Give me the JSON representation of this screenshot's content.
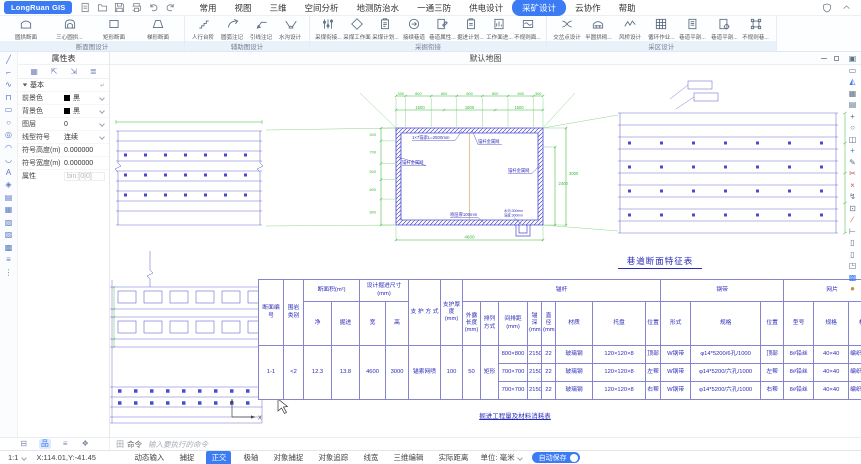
{
  "app": {
    "title": "LongRuan GIS"
  },
  "topbar": {
    "menu": [
      {
        "label": "常用"
      },
      {
        "label": "视图"
      },
      {
        "label": "三维"
      },
      {
        "label": "空间分析"
      },
      {
        "label": "地测防治水"
      },
      {
        "label": "一通三防"
      },
      {
        "label": "供电设计"
      },
      {
        "label": "采矿设计"
      },
      {
        "label": "云协作"
      },
      {
        "label": "帮助"
      }
    ]
  },
  "ribbon": {
    "groups": [
      {
        "label": "断面图设计",
        "items": [
          {
            "label": "圆拱断面",
            "icon": "#i-arch"
          },
          {
            "label": "三心圆拱...",
            "icon": "#i-arch3"
          },
          {
            "label": "矩形断面",
            "icon": "#i-rect"
          },
          {
            "label": "梯形断面",
            "icon": "#i-trap"
          }
        ]
      },
      {
        "label": "辅助图设计",
        "items": [
          {
            "label": "人行台阶",
            "icon": "#i-steps"
          },
          {
            "label": "圆弧注记",
            "icon": "#i-arc"
          },
          {
            "label": "引线注记",
            "icon": "#i-leader"
          },
          {
            "label": "水沟设计",
            "icon": "#i-ditch"
          }
        ]
      },
      {
        "label": "采掘衔接",
        "items": [
          {
            "label": "采煤衔接...",
            "icon": "#i-sliders"
          },
          {
            "label": "采煤工作面",
            "icon": "#i-diamond"
          },
          {
            "label": "采煤计划...",
            "icon": "#i-clip"
          },
          {
            "label": "接续巷道",
            "icon": "#i-link"
          },
          {
            "label": "巷道属性...",
            "icon": "#i-docpen"
          },
          {
            "label": "掘进计划...",
            "icon": "#i-clip2"
          },
          {
            "label": "工作面进...",
            "icon": "#i-docchart"
          },
          {
            "label": "不规则面...",
            "icon": "#i-wave"
          }
        ]
      },
      {
        "label": "采区设计",
        "items": [
          {
            "label": "交岔点设计",
            "icon": "#i-swap"
          },
          {
            "label": "半圆拱砌...",
            "icon": "#i-halfarch"
          },
          {
            "label": "风桥设计",
            "icon": "#i-zig"
          },
          {
            "label": "循环作业...",
            "icon": "#i-grid"
          },
          {
            "label": "巷道平剖...",
            "icon": "#i-docline"
          },
          {
            "label": "巷道平剖...",
            "icon": "#i-docgear"
          },
          {
            "label": "不规则巷...",
            "icon": "#i-corner"
          }
        ]
      }
    ]
  },
  "left_toolbar": {
    "tools": [
      {
        "name": "line",
        "glyph": "╱"
      },
      {
        "name": "polyline",
        "glyph": "⌐"
      },
      {
        "name": "spline",
        "glyph": "∿"
      },
      {
        "name": "multiline",
        "glyph": "⊓"
      },
      {
        "name": "rectangle",
        "glyph": "▭"
      },
      {
        "name": "circle",
        "glyph": "○"
      },
      {
        "name": "circle-center",
        "glyph": "◎"
      },
      {
        "name": "arc",
        "glyph": "◠"
      },
      {
        "name": "ellipse",
        "glyph": "◡"
      },
      {
        "name": "text",
        "glyph": "A"
      },
      {
        "name": "hatch",
        "glyph": "◈"
      },
      {
        "name": "image",
        "glyph": "▤"
      },
      {
        "name": "block",
        "glyph": "▦"
      },
      {
        "name": "xref",
        "glyph": "▧"
      },
      {
        "name": "region",
        "glyph": "▨"
      },
      {
        "name": "map",
        "glyph": "▩"
      },
      {
        "name": "align",
        "glyph": "≡"
      },
      {
        "name": "more",
        "glyph": "⋮"
      }
    ]
  },
  "right_toolbar": {
    "tools": [
      {
        "name": "copy",
        "glyph": "▣"
      },
      {
        "name": "delete",
        "glyph": "▭"
      },
      {
        "name": "mirror",
        "glyph": "◭"
      },
      {
        "name": "array",
        "glyph": "▦"
      },
      {
        "name": "print-area",
        "glyph": "▤"
      },
      {
        "name": "move",
        "glyph": "+"
      },
      {
        "name": "rotate",
        "glyph": "○"
      },
      {
        "name": "duplicate",
        "glyph": "◫"
      },
      {
        "name": "add",
        "glyph": "+"
      },
      {
        "name": "pencil",
        "glyph": "✎"
      },
      {
        "name": "cut",
        "glyph": "✂"
      },
      {
        "name": "break",
        "glyph": "×"
      },
      {
        "name": "stretch",
        "glyph": "↯"
      },
      {
        "name": "marquee",
        "glyph": "⊡"
      },
      {
        "name": "trim",
        "glyph": "∕"
      },
      {
        "name": "extend",
        "glyph": "⊢"
      },
      {
        "name": "clipboard",
        "glyph": "▯"
      },
      {
        "name": "clipboard-paste",
        "glyph": "▯"
      },
      {
        "name": "view-cube",
        "glyph": "◳"
      },
      {
        "name": "pattern",
        "glyph": "▩"
      },
      {
        "name": "sphere",
        "glyph": "●"
      }
    ]
  },
  "panel": {
    "title": "属性表",
    "tabs": [
      {
        "name": "properties",
        "glyph": "▦"
      },
      {
        "name": "select",
        "glyph": "⇱"
      },
      {
        "name": "pick",
        "glyph": "⇲"
      },
      {
        "name": "layers",
        "glyph": "≣"
      }
    ],
    "section": "基本",
    "rows": [
      {
        "label": "前景色",
        "value": "黑"
      },
      {
        "label": "背景色",
        "value": "黑"
      },
      {
        "label": "图层",
        "value": "0"
      },
      {
        "label": "线型符号",
        "value": "连续"
      },
      {
        "label": "符号高度(m)",
        "value": "0.000000"
      },
      {
        "label": "符号宽度(m)",
        "value": "0.000000"
      },
      {
        "label": "属性",
        "value": "bin:[0|0]"
      }
    ]
  },
  "bottom_tabs": {
    "tabs": [
      {
        "name": "list",
        "glyph": "⊟"
      },
      {
        "name": "structure",
        "glyph": "品"
      },
      {
        "name": "layers",
        "glyph": "≡"
      },
      {
        "name": "styles",
        "glyph": "❖"
      }
    ]
  },
  "canvas": {
    "tab": "默认地图",
    "drawing": {
      "dims_top": [
        "300",
        "800",
        "800",
        "800",
        "800",
        "800",
        "300"
      ],
      "dims_mid": [
        "1500",
        "1600",
        "1500"
      ],
      "dims_left": [
        "400",
        "700",
        "500",
        "600",
        "800"
      ],
      "dim_right_a": "2400",
      "dim_right_b": "3000",
      "dim_bottom": "4600",
      "anchor_label": "1×7锚索L=2500mm",
      "mesh_label": "锚杆金属网",
      "spray_label": "喷层厚100mm",
      "ditch_label_1": "水沟:300mm",
      "ditch_label_2": "深度:300mm",
      "axis_x": "X"
    },
    "table_title": "巷道断面特征表",
    "table_caption": "掘进工程量及材料消耗表"
  },
  "feature_table": {
    "header": {
      "c1": "断面编号",
      "c2": "围岩类别",
      "area": "断面积(m²)",
      "net": "净",
      "dig": "掘进",
      "size": "设计掘进尺寸(mm)",
      "w": "宽",
      "h": "高",
      "support": "支 护 方 式",
      "thick": "支护厚度(mm)",
      "bolt": "锚杆",
      "exposed": "外露长度(mm)",
      "arrange": "排列方式",
      "spacing": "间排距(mm)",
      "depth": "锚深(mm)",
      "dia": "直径(mm)",
      "mat": "材质",
      "plate": "托盘",
      "pos": "位置",
      "band": "钢带",
      "form": "形式",
      "spec": "规格",
      "pos2": "位置",
      "mesh": "网片",
      "model": "型号",
      "spec2": "规格",
      "mat2": "材质"
    },
    "merged": {
      "no": "1-1",
      "rock": "<2",
      "net": "12.3",
      "dig": "13.8",
      "w": "4600",
      "h": "3000",
      "support": "锚索网喷",
      "thick": "100",
      "exposed": "50",
      "arrange": "矩形"
    },
    "rows": [
      {
        "spacing": "800×800",
        "depth": "2150",
        "dia": "22",
        "mat": "玻璃钢",
        "plate": "120×120×8",
        "pos": "顶部",
        "form": "W钢带",
        "spec": "φ14*5200/6孔/1000",
        "pos2": "顶部",
        "model": "8#铅丝",
        "spec2": "40×40",
        "mat2": "编织金属网"
      },
      {
        "spacing": "700×700",
        "depth": "2150",
        "dia": "22",
        "mat": "玻璃钢",
        "plate": "120×120×8",
        "pos": "左帮",
        "form": "W钢带",
        "spec": "φ14*5200/六孔/1000",
        "pos2": "左帮",
        "model": "8#铅丝",
        "spec2": "40×40",
        "mat2": "编织金属网"
      },
      {
        "spacing": "700×700",
        "depth": "2150",
        "dia": "22",
        "mat": "玻璃钢",
        "plate": "120×120×8",
        "pos": "右帮",
        "form": "W钢带",
        "spec": "φ14*5200/六孔/1000",
        "pos2": "右帮",
        "model": "8#铅丝",
        "spec2": "40×40",
        "mat2": "编织金属网"
      }
    ]
  },
  "command": {
    "icon_glyph": "田",
    "label": "命令",
    "placeholder": "输入要执行的命令"
  },
  "status": {
    "scale": "1:1",
    "coords": "X:114.01,Y:-41.45",
    "buttons": [
      "动态输入",
      "捕捉",
      "正交",
      "极轴",
      "对象捕捉",
      "对象追踪",
      "线宽",
      "三维编辑",
      "实际距离"
    ],
    "unit": "单位: 毫米",
    "autosave": "自动保存"
  }
}
